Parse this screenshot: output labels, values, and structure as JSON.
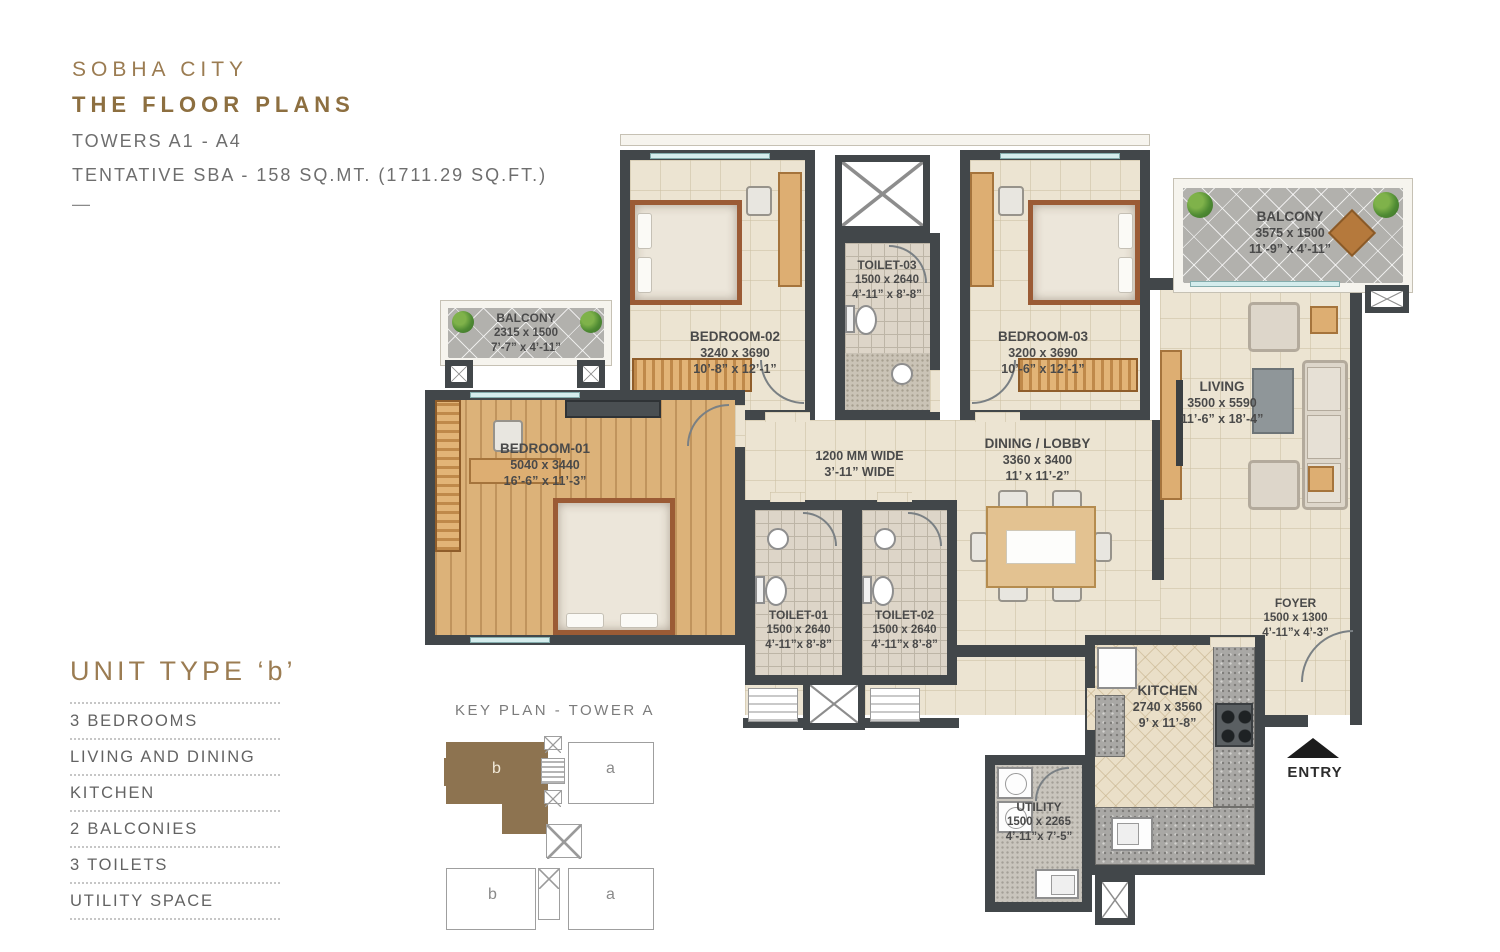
{
  "header": {
    "project": "SOBHA CITY",
    "title": "THE FLOOR PLANS",
    "towers": "TOWERS A1 - A4",
    "sba": "TENTATIVE SBA - 158 SQ.MT. (1711.29 SQ.FT.)",
    "dash": "—"
  },
  "unit": {
    "title": "UNIT TYPE ‘b’",
    "features": [
      "3 BEDROOMS",
      "LIVING AND DINING",
      "KITCHEN",
      "2 BALCONIES",
      "3 TOILETS",
      "UTILITY SPACE"
    ]
  },
  "key_plan": {
    "title": "KEY PLAN - TOWER A",
    "units": [
      "b",
      "a",
      "b",
      "a"
    ],
    "highlight_color": "#8d7350"
  },
  "rooms": {
    "bedroom2": {
      "name": "BEDROOM-02",
      "mm": "3240 x 3690",
      "ft": "10’-8” x 12’-1”"
    },
    "toilet3": {
      "name": "TOILET-03",
      "mm": "1500 x 2640",
      "ft": "4’-11” x 8’-8”"
    },
    "bedroom3": {
      "name": "BEDROOM-03",
      "mm": "3200 x 3690",
      "ft": "10’-6” x 12’-1”"
    },
    "balcony2": {
      "name": "BALCONY",
      "mm": "3575 x 1500",
      "ft": "11’-9” x 4’-11”"
    },
    "living": {
      "name": "LIVING",
      "mm": "3500 x 5590",
      "ft": "11’-6” x 18’-4”"
    },
    "balcony1": {
      "name": "BALCONY",
      "mm": "2315 x 1500",
      "ft": "7’-7” x 4’-11”"
    },
    "bedroom1": {
      "name": "BEDROOM-01",
      "mm": "5040 x 3440",
      "ft": "16’-6” x 11’-3”"
    },
    "corridor": {
      "line1": "1200 MM WIDE",
      "line2": "3’-11” WIDE"
    },
    "dining": {
      "name": "DINING / LOBBY",
      "mm": "3360 x 3400",
      "ft": "11’ x 11’-2”"
    },
    "toilet1": {
      "name": "TOILET-01",
      "mm": "1500 x 2640",
      "ft": "4’-11”x 8’-8”"
    },
    "toilet2": {
      "name": "TOILET-02",
      "mm": "1500 x 2640",
      "ft": "4’-11”x 8’-8”"
    },
    "foyer": {
      "name": "FOYER",
      "mm": "1500 x 1300",
      "ft": "4’-11”x 4’-3”"
    },
    "kitchen": {
      "name": "KITCHEN",
      "mm": "2740 x 3560",
      "ft": "9’ x 11’-8”"
    },
    "utility": {
      "name": "UTILITY",
      "mm": "1500 x 2265",
      "ft": "4’-11”x 7’-5”"
    },
    "entry": {
      "label": "ENTRY"
    }
  },
  "colors": {
    "accent_brown": "#8d6f40",
    "wall": "#42474a",
    "floor_cream": "#ece4d2"
  }
}
